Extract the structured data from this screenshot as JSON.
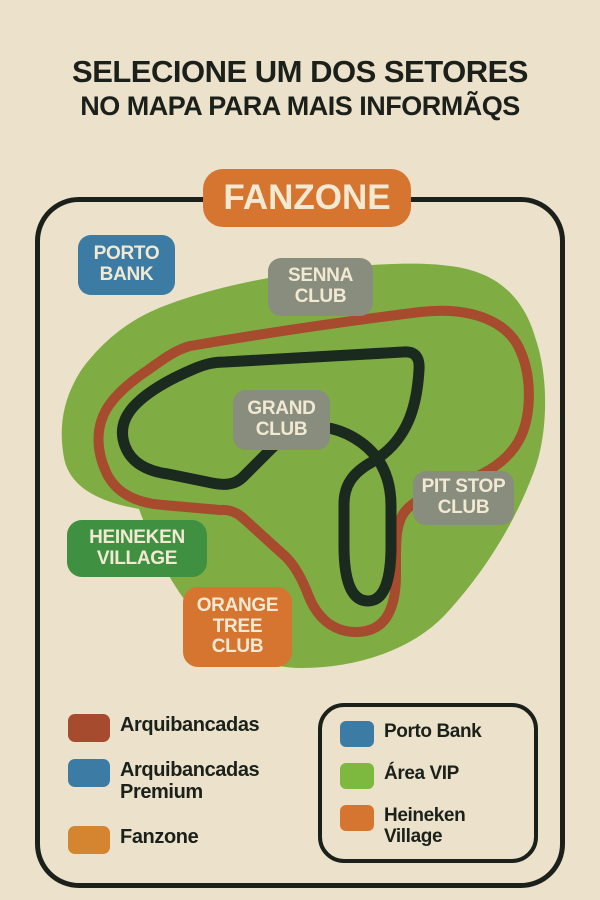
{
  "title": {
    "line1": "SELECIONE UM DOS SETORES",
    "line2": "NO MAPA PARA MAIS INFORMÃQS"
  },
  "map": {
    "fanzone": "FANZONE",
    "porto_bank": [
      "PORTO",
      "BANK"
    ],
    "senna_club": [
      "SENNA",
      "CLUB"
    ],
    "grand_club": [
      "GRAND",
      "CLUB"
    ],
    "pit_stop_club": [
      "PIT STOP",
      "CLUB"
    ],
    "heineken_village": [
      "HEINEKEN",
      "VILLAGE"
    ],
    "orange_tree_club": [
      "ORANGE",
      "TREE",
      "CLUB"
    ]
  },
  "legend": {
    "left": [
      {
        "label": "Arquibancadas",
        "color": "#a64b2e"
      },
      {
        "label": "Arquibancadas Premium",
        "color": "#3c7ba3"
      },
      {
        "label": "Fanzone",
        "color": "#d5852f"
      }
    ],
    "right": [
      {
        "label": "Porto Bank",
        "color": "#3c7ba3"
      },
      {
        "label": "Área VIP",
        "color": "#7cb93e"
      },
      {
        "label": "Heineken Village",
        "color": "#d5752f"
      }
    ]
  },
  "colors": {
    "background": "#ece2cb",
    "outline": "#1b211a",
    "track": "#1b2a1e",
    "grandstands_red": "#a64b2e",
    "premium_blue": "#3c7ba3",
    "fanzone_orange": "#d5752f",
    "vip_green": "#7fad43",
    "heineken_green": "#3f9040",
    "club_gray": "#888d7d",
    "label_cream": "#f2e9d3"
  }
}
